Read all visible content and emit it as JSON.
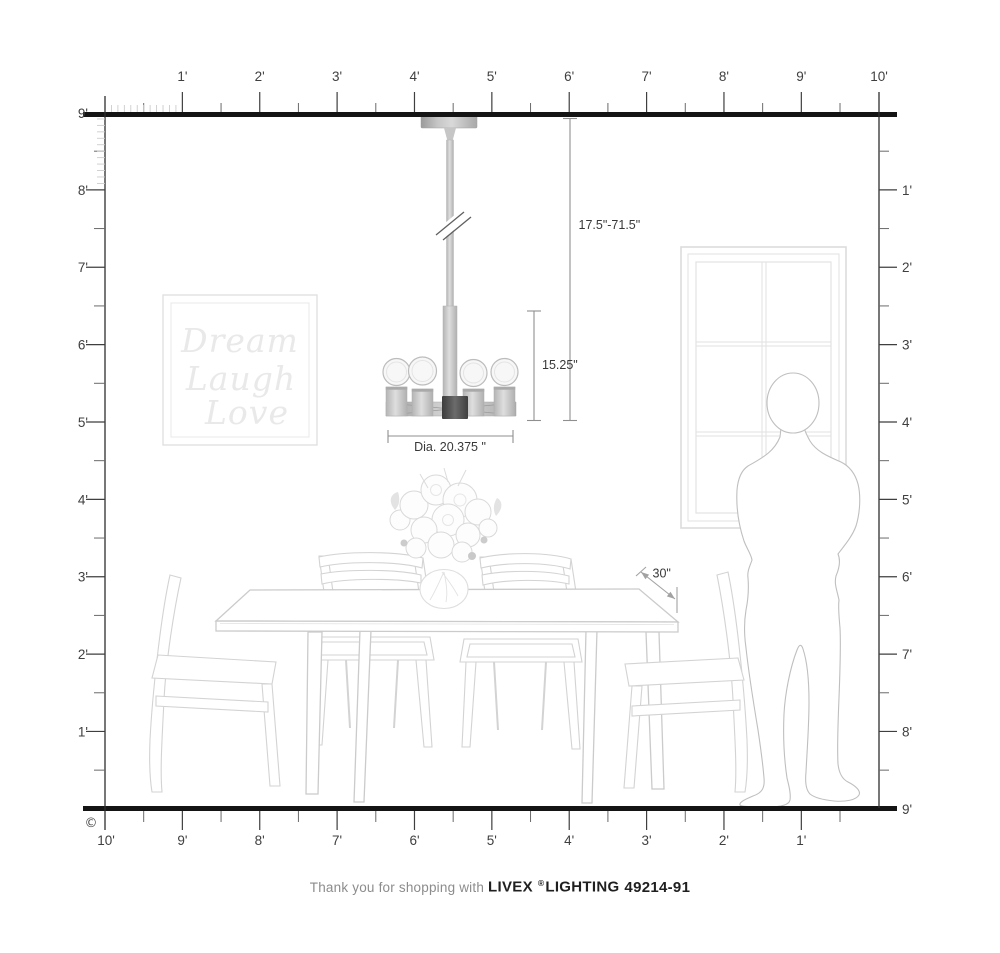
{
  "diagram": {
    "copyright_symbol": "©",
    "rulers": {
      "top_labels": [
        "1'",
        "2'",
        "3'",
        "4'",
        "5'",
        "6'",
        "7'",
        "8'",
        "9'",
        "10'"
      ],
      "bottom_labels": [
        "10'",
        "9'",
        "8'",
        "7'",
        "6'",
        "5'",
        "4'",
        "3'",
        "2'",
        "1'"
      ],
      "left_labels": [
        "9'",
        "8'",
        "7'",
        "6'",
        "5'",
        "4'",
        "3'",
        "2'",
        "1'"
      ],
      "right_labels": [
        "1'",
        "2'",
        "3'",
        "4'",
        "5'",
        "6'",
        "7'",
        "8'",
        "9'"
      ]
    },
    "dimensions": {
      "hanging_height_range": "17.5\"-71.5\"",
      "fixture_height": "15.25\"",
      "fixture_diameter": "Dia. 20.375 \"",
      "table_depth": "30\""
    },
    "wall_art": {
      "line1": "Dream",
      "line2": "Laugh",
      "line3": "Love"
    },
    "colors": {
      "ruler_line": "#141414",
      "dimension_stroke": "#8f8f8f",
      "scene_stroke": "#d3d3d3",
      "fixture_metal": "#b9b9b9"
    }
  },
  "footer": {
    "message": "Thank you for shopping with",
    "brand": "LIVEX",
    "registered_mark": "®",
    "brand_suffix": "LIGHTING",
    "model_number": "49214-91"
  }
}
